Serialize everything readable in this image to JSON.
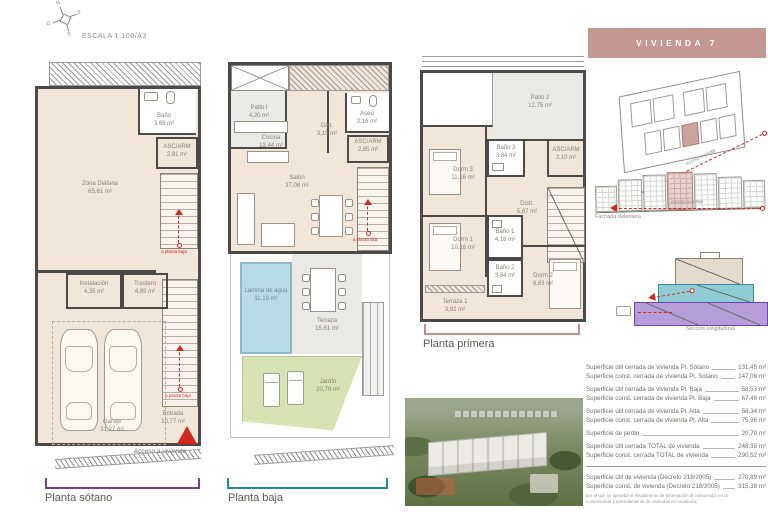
{
  "meta": {
    "scale": "ESCALA 1:100/A3",
    "compass": {
      "n": "N",
      "e": "E",
      "s": "S",
      "o": "O"
    }
  },
  "header": {
    "title": "VIVIENDA 7",
    "bg": "#c49793"
  },
  "plans": {
    "sotano": {
      "label": "Planta sótano",
      "bracket_color": "#7a3f86",
      "stair_note": "a planta baja",
      "access_label": "Acceso a vivienda",
      "rooms": [
        {
          "name": "Baño",
          "area": "3,69 m²"
        },
        {
          "name": "ASC/ARM",
          "area": "2,81 m²"
        },
        {
          "name": "Zona Diáfana",
          "area": "65,61 m²"
        },
        {
          "name": "Instalación",
          "area": "4,35 m²"
        },
        {
          "name": "Trastero",
          "area": "4,89 m²"
        },
        {
          "name": "Garaje",
          "area": "31,27 m²"
        },
        {
          "name": "Entrada",
          "area": "10,77 m²"
        }
      ]
    },
    "baja": {
      "label": "Planta baja",
      "bracket_color": "#1f8b96",
      "stair_note": "a planta alta",
      "rooms": [
        {
          "name": "Patio I",
          "area": "4,20 m²"
        },
        {
          "name": "Aseo",
          "area": "2,16 m²"
        },
        {
          "name": "Dist.",
          "area": "3,15 m²"
        },
        {
          "name": "ASC/ARM",
          "area": "2,85 m²"
        },
        {
          "name": "Cocina",
          "area": "13,44 m²"
        },
        {
          "name": "Salón",
          "area": "37,08 m²"
        },
        {
          "name": "Lámina de agua",
          "area": "11,19 m²"
        },
        {
          "name": "Terraza",
          "area": "15,61 m²"
        },
        {
          "name": "Jardín",
          "area": "20,79 m²"
        }
      ]
    },
    "primera": {
      "label": "Planta primera",
      "bracket_color": "#bf8f8b",
      "rooms": [
        {
          "name": "Patio 2",
          "area": "12,75 m²"
        },
        {
          "name": "Baño 3",
          "area": "3,84 m²"
        },
        {
          "name": "ASC/ARM",
          "area": "3,10 m²"
        },
        {
          "name": "Dorm 3",
          "area": "11,16 m²"
        },
        {
          "name": "Distr.",
          "area": "5,67 m²"
        },
        {
          "name": "Dorm 1",
          "area": "10,16 m²"
        },
        {
          "name": "Baño 1",
          "area": "4,16 m²"
        },
        {
          "name": "Baño 2",
          "area": "3,84 m²"
        },
        {
          "name": "Dorm 2",
          "area": "9,83 m²"
        },
        {
          "name": "Terraza 1",
          "area": "3,92 m²"
        }
      ]
    }
  },
  "site": {
    "access_garage": "Acceso a garaje",
    "facade_label": "Fachada delantera",
    "section_label": "Sección longitudinal"
  },
  "areas_table": {
    "rows": [
      {
        "label": "Superficie útil cerrada de vivienda Pl. Sótano",
        "value": "131,45 m²"
      },
      {
        "label": "Superficie const. cerrada de vivienda Pl. Sótano",
        "value": "147,08 m²"
      },
      {
        "label": "Superficie útil cerrada de vivienda Pl. Baja",
        "value": "58,53 m²"
      },
      {
        "label": "Superficie const. cerrada de vivienda Pl. Baja",
        "value": "67,48 m²"
      },
      {
        "label": "Superficie útil cerrada de vivienda Pl. Alta",
        "value": "58,34 m²"
      },
      {
        "label": "Superficie const. cerrada de vivienda Pl. Alta",
        "value": "75,96 m²"
      },
      {
        "label": "Superficie de jardín",
        "value": "20,79 m²"
      },
      {
        "label": "Superficie útil cerrada TOTAL de vivienda",
        "value": "248,35 m²"
      },
      {
        "label": "Superficie const. cerrada TOTAL de vivienda",
        "value": "290,52 m²"
      },
      {
        "label": "Superficie útil de vivienda (Decreto 218/2005)",
        "value": "270,89 m²"
      },
      {
        "label": "Superficie const. de vivienda (Decreto 218/2005)",
        "value": "315,38 m²"
      }
    ],
    "footnote": "por el que se aprueba el Reglamento de Información al consumidor en la compraventa y arrendamiento de viviendas en Andalucía"
  },
  "colors": {
    "accent_red": "#d3281e",
    "pool_blue": "#b9dae8",
    "garden_green": "#d8e3b4",
    "section_purple": "#b49dd9",
    "section_teal": "#8fccd5",
    "section_beige": "#e5dbcd"
  }
}
